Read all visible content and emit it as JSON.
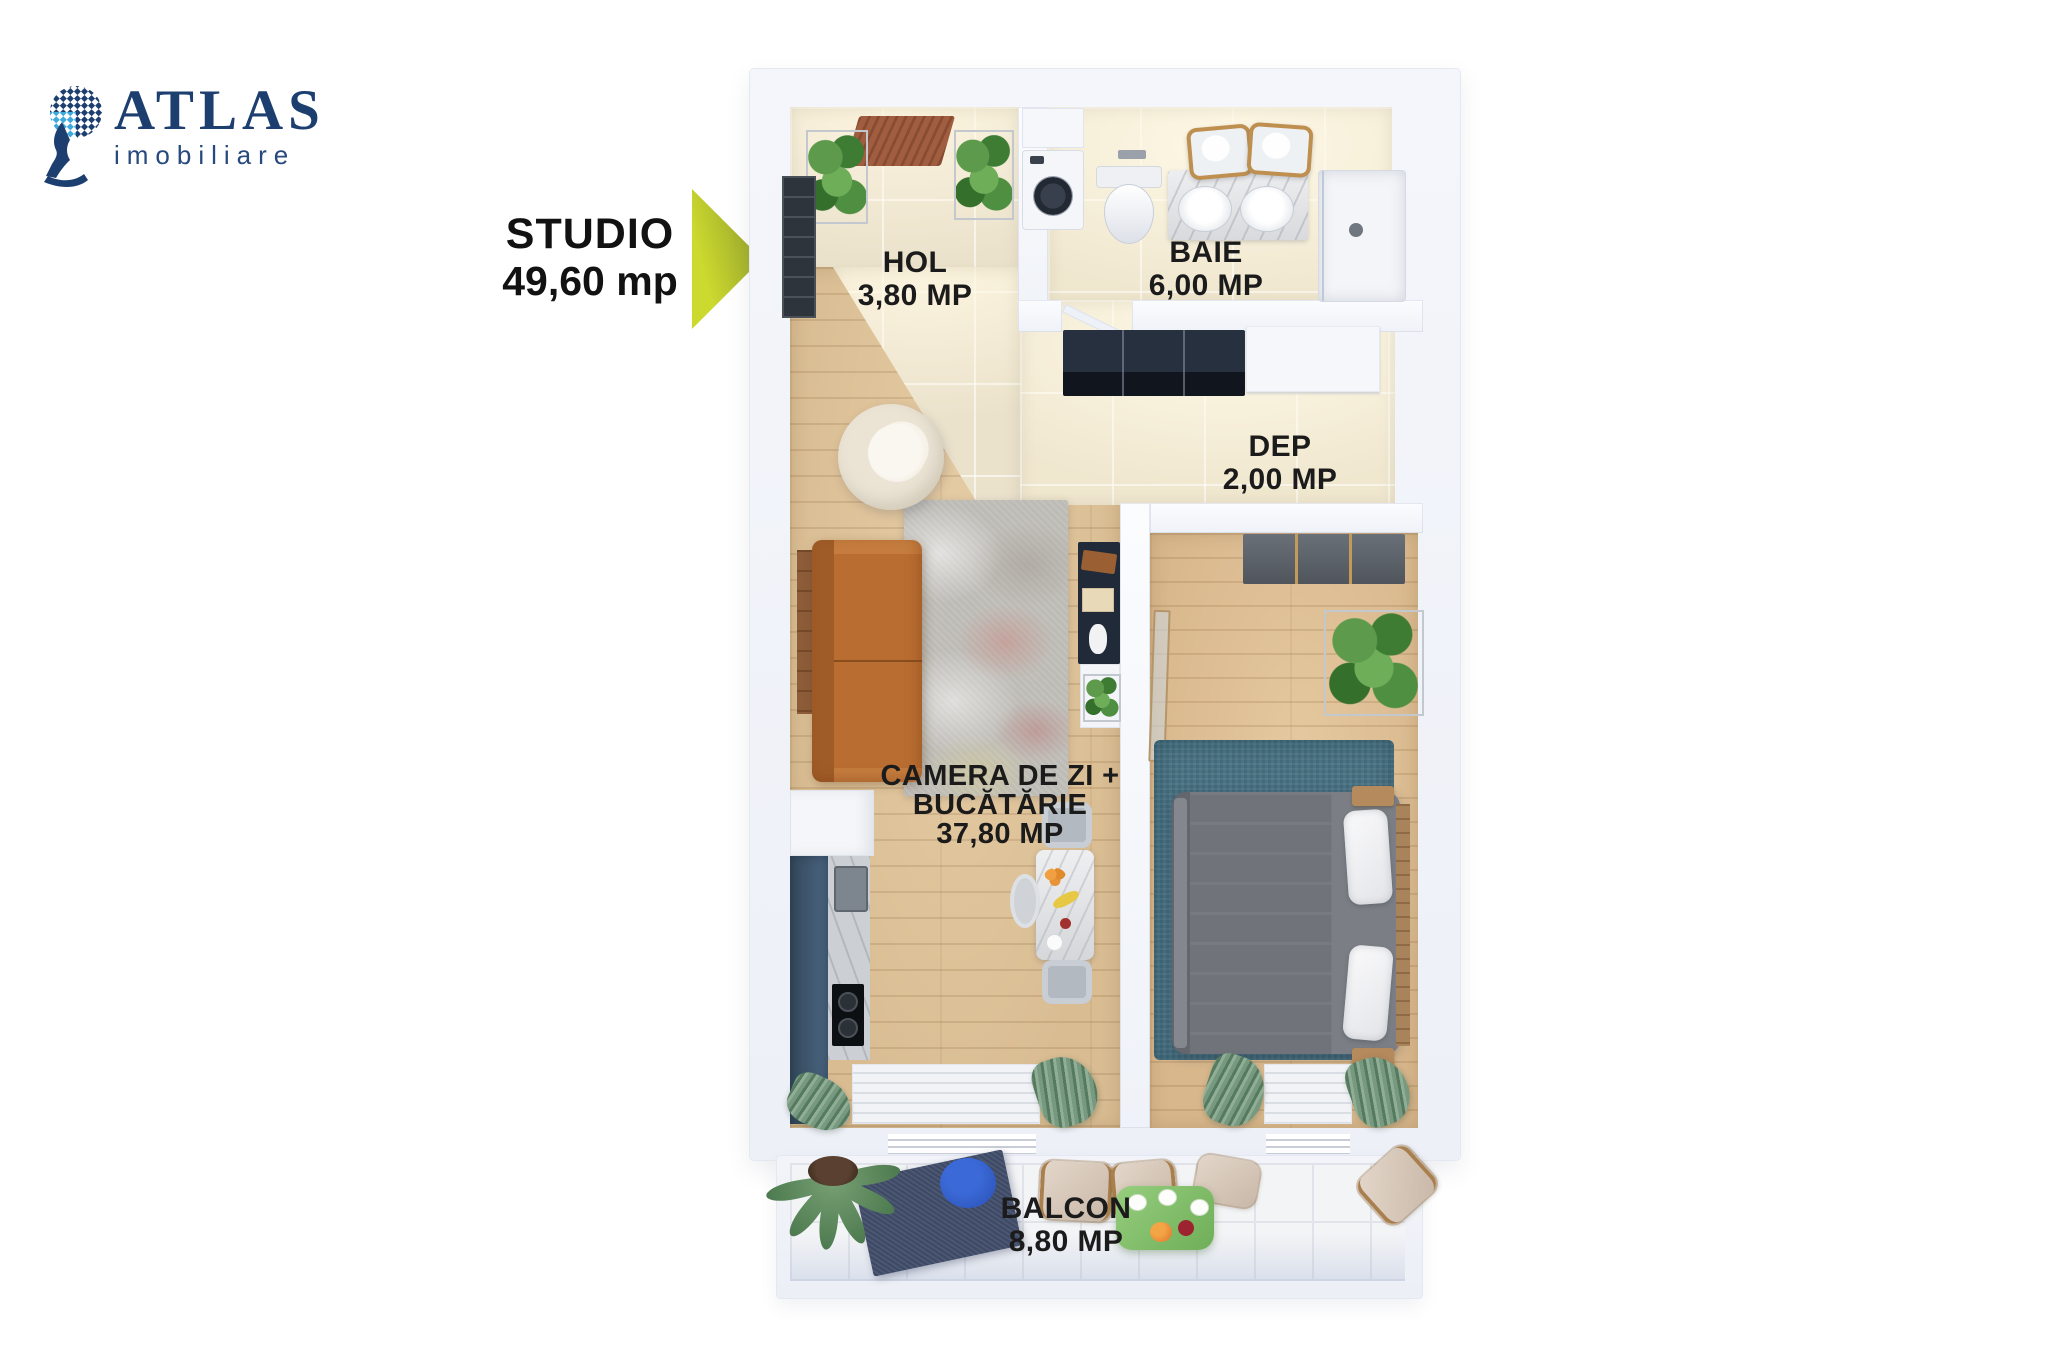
{
  "brand": {
    "name": "ATLAS",
    "tagline": "imobiliare",
    "navy": "#1d3f6f",
    "light_blue": "#3fa9dc"
  },
  "callout": {
    "title": "STUDIO",
    "area": "49,60 mp",
    "arrow_color_start": "#ccd92f",
    "arrow_color_end": "#8f9d2c"
  },
  "floorplan": {
    "label_color": "#1b1b1b",
    "rooms": {
      "hol": {
        "label": "HOL",
        "area": "3,80 MP"
      },
      "baie": {
        "label": "BAIE",
        "area": "6,00 MP"
      },
      "dep": {
        "label": "DEP",
        "area": "2,00 MP"
      },
      "living": {
        "label_line1": "CAMERA DE ZI +",
        "label_line2": "BUCĂTĂRIE",
        "area": "37,80 MP"
      },
      "balcon": {
        "label": "BALCON",
        "area": "8,80 MP"
      }
    }
  }
}
